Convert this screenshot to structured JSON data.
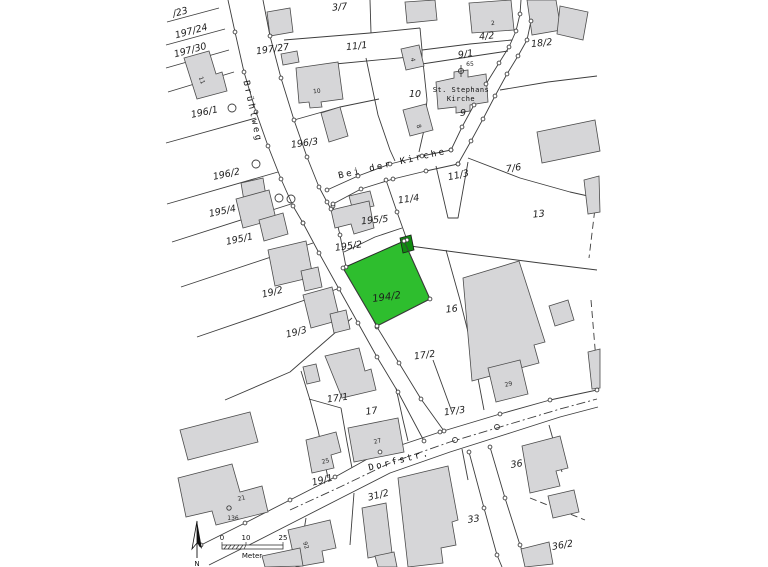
{
  "map": {
    "streets": [
      {
        "t": "Brühlweg",
        "x": 250,
        "y": 112,
        "r": 78
      },
      {
        "t": "Bei der Kirche",
        "x": 393,
        "y": 166,
        "r": -13
      },
      {
        "t": "Dorfstr.",
        "x": 400,
        "y": 463,
        "r": -14
      }
    ],
    "parcels": [
      {
        "t": "/23",
        "x": 181,
        "y": 15,
        "r": -15
      },
      {
        "t": "197/24",
        "x": 192,
        "y": 34,
        "r": -15
      },
      {
        "t": "197/30",
        "x": 191,
        "y": 53,
        "r": -15
      },
      {
        "t": "196/1",
        "x": 205,
        "y": 115,
        "r": -12
      },
      {
        "t": "197/27",
        "x": 273,
        "y": 52,
        "r": -8
      },
      {
        "t": "3/7",
        "x": 340,
        "y": 10,
        "r": -6
      },
      {
        "t": "11/1",
        "x": 357,
        "y": 49,
        "r": -6
      },
      {
        "t": "4/2",
        "x": 487,
        "y": 39,
        "r": -6
      },
      {
        "t": "9/1",
        "x": 466,
        "y": 57,
        "r": -8
      },
      {
        "t": "18/2",
        "x": 542,
        "y": 46,
        "r": -6
      },
      {
        "t": "10",
        "x": 415,
        "y": 97,
        "r": 0
      },
      {
        "t": "9",
        "x": 463,
        "y": 116,
        "r": 0
      },
      {
        "t": "196/2",
        "x": 227,
        "y": 177,
        "r": -12
      },
      {
        "t": "196/3",
        "x": 305,
        "y": 146,
        "r": -8
      },
      {
        "t": "195/4",
        "x": 223,
        "y": 214,
        "r": -12
      },
      {
        "t": "195/1",
        "x": 240,
        "y": 242,
        "r": -12
      },
      {
        "t": "195/5",
        "x": 375,
        "y": 223,
        "r": -6
      },
      {
        "t": "195/2",
        "x": 349,
        "y": 249,
        "r": -8
      },
      {
        "t": "11/4",
        "x": 409,
        "y": 202,
        "r": -8
      },
      {
        "t": "11/3",
        "x": 459,
        "y": 178,
        "r": -12
      },
      {
        "t": "7/6",
        "x": 514,
        "y": 171,
        "r": -8
      },
      {
        "t": "13",
        "x": 539,
        "y": 217,
        "r": -6
      },
      {
        "t": "16",
        "x": 452,
        "y": 312,
        "r": -6
      },
      {
        "t": "19/2",
        "x": 273,
        "y": 295,
        "r": -14
      },
      {
        "t": "19/3",
        "x": 297,
        "y": 335,
        "r": -14
      },
      {
        "t": "17/2",
        "x": 425,
        "y": 358,
        "r": -8
      },
      {
        "t": "17/1",
        "x": 338,
        "y": 401,
        "r": -8
      },
      {
        "t": "17",
        "x": 372,
        "y": 414,
        "r": -8
      },
      {
        "t": "17/3",
        "x": 455,
        "y": 414,
        "r": -8
      },
      {
        "t": "19/1",
        "x": 323,
        "y": 483,
        "r": -14
      },
      {
        "t": "31/2",
        "x": 379,
        "y": 498,
        "r": -14
      },
      {
        "t": "36",
        "x": 517,
        "y": 467,
        "r": -8
      },
      {
        "t": "33",
        "x": 474,
        "y": 522,
        "r": -8
      },
      {
        "t": "36/2",
        "x": 563,
        "y": 548,
        "r": -10
      }
    ],
    "building_numbers": [
      {
        "t": "11",
        "x": 200,
        "y": 81,
        "r": 70
      },
      {
        "t": "10",
        "x": 317,
        "y": 93,
        "r": -6
      },
      {
        "t": "2",
        "x": 493,
        "y": 25,
        "r": -4
      },
      {
        "t": "4",
        "x": 411,
        "y": 60,
        "r": 80
      },
      {
        "t": "8",
        "x": 417,
        "y": 127,
        "r": 70
      },
      {
        "t": "27",
        "x": 378,
        "y": 443,
        "r": -14
      },
      {
        "t": "25",
        "x": 326,
        "y": 463,
        "r": -14
      },
      {
        "t": "21",
        "x": 242,
        "y": 500,
        "r": -14
      },
      {
        "t": "136",
        "x": 233,
        "y": 520,
        "r": 0
      },
      {
        "t": "29",
        "x": 509,
        "y": 386,
        "r": -14
      },
      {
        "t": "92",
        "x": 304,
        "y": 546,
        "r": 70
      }
    ],
    "church": {
      "l1": "St. Stephans",
      "l2": "Kirche",
      "num": "65"
    },
    "highlight": {
      "label": "194/2",
      "x": 387,
      "y": 300,
      "r": -8,
      "fill": "#2ebe2e",
      "marker_fill": "#0f8a0f"
    },
    "scalebar": {
      "ticks": [
        "0",
        "10",
        "25"
      ],
      "tick_x": [
        222,
        246,
        283
      ],
      "unit": "Meter"
    },
    "north": "N"
  }
}
